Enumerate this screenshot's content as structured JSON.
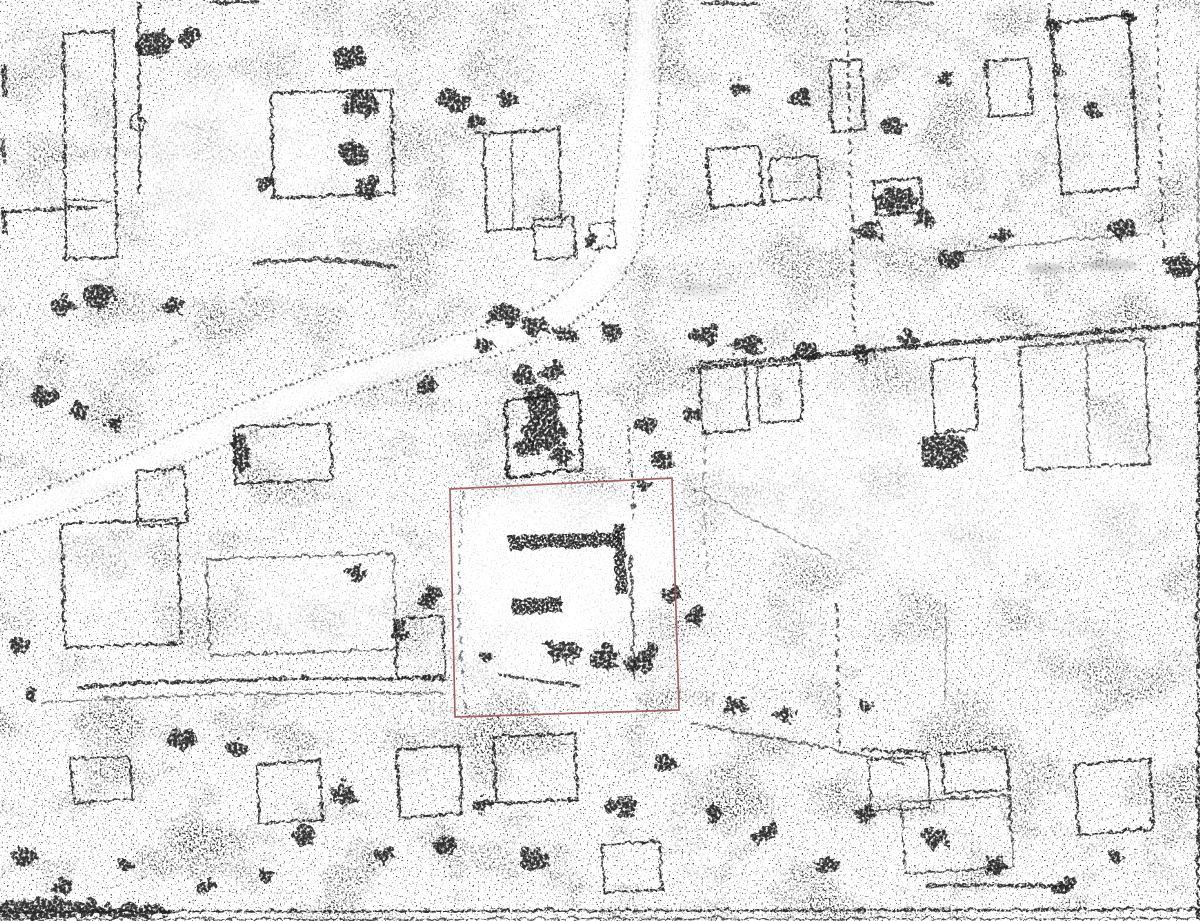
{
  "document": {
    "kind": "scanned-aerial-photograph",
    "visible_text": "none (no legible text in image)"
  },
  "canvas": {
    "width": 1200,
    "height": 921,
    "background": "#ffffff"
  },
  "palette": {
    "paper": "#ffffff",
    "ink": "#1d1d1d",
    "ink_soft": "#2e2e2e",
    "road_ink": "#303030",
    "smudge": "#777777",
    "red_boundary": "#a2585c"
  },
  "annotations": {
    "red_plot_boundary": {
      "points": "450,489 672,478 679,710 455,717",
      "stroke": "#a2585c",
      "stroke_width": 1.7,
      "opacity": 0.95
    },
    "center_building_outline": {
      "points": "504,399 577,391 581,468 507,476",
      "stroke": "#141414",
      "stroke_width": 3,
      "opacity": 0.95
    }
  },
  "features": {
    "road_style": {
      "width": 2.2,
      "dash": "2.5 3.5",
      "opacity": 0.85
    },
    "roads": [
      {
        "n": "road-edge-west",
        "d": "M628,-6 C622,70 621,150 609,228 C587,286 530,316 460,332 C370,353 294,378 209,416 C134,450 60,482 -6,506"
      },
      {
        "n": "road-edge-east",
        "d": "M666,-6 C659,85 653,165 639,243 C615,306 551,341 479,357 C391,378 311,403 229,441 C151,477 77,509 -6,533"
      }
    ],
    "clearing_strokes": [
      {
        "n": "road-surface",
        "d": "M647,-6 C640,80 636,160 622,236 C600,300 540,330 468,346 C380,366 300,392 216,430 C140,464 66,496 -6,520",
        "w": 26,
        "o": 0.9
      }
    ],
    "clearings": [
      [
        560,
        560,
        115,
        75,
        0.8
      ],
      [
        520,
        640,
        70,
        45,
        0.6
      ],
      [
        330,
        600,
        80,
        45,
        0.5
      ],
      [
        235,
        165,
        95,
        85,
        0.55
      ],
      [
        940,
        480,
        240,
        95,
        0.45
      ],
      [
        90,
        560,
        60,
        50,
        0.4
      ],
      [
        580,
        260,
        60,
        40,
        0.4
      ]
    ],
    "smudges": [
      [
        1045,
        268,
        20,
        5,
        0.3
      ],
      [
        1112,
        265,
        26,
        6,
        0.3
      ],
      [
        700,
        290,
        30,
        8,
        0.15
      ]
    ],
    "paths": [
      {
        "n": "pen-mark-line",
        "d": "M138,0 L138,192",
        "w": 2.6
      },
      {
        "n": "pen-mark-loop",
        "d": "M129,122 a7,8 0 1 0 14,0 a7,8 0 1 0 -14,0",
        "w": 2
      },
      {
        "n": "left-enclosure-outline",
        "d": "M62,32 L112,30 L116,255 L64,258 Z",
        "w": 2.5
      },
      {
        "n": "left-enclosure-inner",
        "d": "M64,198 L112,200",
        "w": 2
      },
      {
        "n": "house-outline",
        "d": "M270,92 L390,88 L393,192 L272,196 Z",
        "w": 3
      },
      {
        "n": "house-outline",
        "d": "M482,132 L557,128 L560,225 L485,229 Z",
        "w": 2.5
      },
      {
        "n": "house-inner-wall",
        "d": "M510,132 L512,228",
        "w": 2
      },
      {
        "n": "shed-outline",
        "d": "M532,218 L572,216 L574,256 L534,258 Z",
        "w": 2.5
      },
      {
        "n": "shed-outline",
        "d": "M588,222 L612,220 L614,246 L590,248 Z",
        "w": 2
      },
      {
        "n": "house-outline",
        "d": "M705,148 L758,144 L762,202 L709,206 Z",
        "w": 3
      },
      {
        "n": "house-outline",
        "d": "M768,158 L816,154 L819,196 L771,200 Z",
        "w": 2.5
      },
      {
        "n": "house-outline",
        "d": "M828,60 L860,58 L863,128 L831,130 Z",
        "w": 2.5
      },
      {
        "n": "house-outline",
        "d": "M872,180 L918,176 L921,210 L875,214 Z",
        "w": 3
      },
      {
        "n": "house-outline",
        "d": "M985,60 L1028,57 L1031,112 L988,115 Z",
        "w": 2.5
      },
      {
        "n": "large-building-outline",
        "d": "M1050,23 L1127,13 L1137,186 L1060,192 Z",
        "w": 3
      },
      {
        "n": "boundary-line",
        "d": "M1155,5 L1162,250",
        "w": 2.5,
        "dash": "7 6",
        "o": 0.8
      },
      {
        "n": "hedgerow-long-east",
        "d": "M688,368 C780,358 900,345 1000,338 C1080,332 1150,326 1200,322",
        "w": 4.5
      },
      {
        "n": "hedgerow",
        "d": "M845,5 C848,90 850,200 853,330",
        "w": 3,
        "dash": "6 5",
        "o": 0.85
      },
      {
        "n": "house-outline",
        "d": "M698,362 L744,358 L747,428 L701,432 Z",
        "w": 2.5
      },
      {
        "n": "house-outline",
        "d": "M755,365 L798,362 L801,418 L758,421 Z",
        "w": 2.5
      },
      {
        "n": "house-outline",
        "d": "M930,360 L973,356 L976,428 L933,432 Z",
        "w": 2.5
      },
      {
        "n": "field-enclosure-outline",
        "d": "M1018,345 L1143,338 L1148,462 L1023,468 Z",
        "w": 2.5,
        "o": 0.85
      },
      {
        "n": "field-enclosure-inner",
        "d": "M1085,340 L1088,465",
        "w": 2,
        "o": 0.7
      },
      {
        "n": "house-outline",
        "d": "M232,426 L328,422 L331,478 L235,482 Z",
        "w": 2.5
      },
      {
        "n": "house-outline",
        "d": "M135,470 L183,467 L186,522 L138,525 Z",
        "w": 2.5
      },
      {
        "n": "farm-enclosure-outline",
        "d": "M60,522 L176,518 L180,642 L64,646 Z",
        "w": 2.5
      },
      {
        "n": "field-boundary",
        "d": "M205,558 L392,552 L396,648 L209,654 Z",
        "w": 2,
        "o": 0.75
      },
      {
        "n": "plot-building-wall",
        "d": "M507,534 L619,530 L620,545 L508,549 Z",
        "w": 1,
        "f": 1
      },
      {
        "n": "plot-building-wall",
        "d": "M612,523 L623,522 L626,592 L615,593 Z",
        "w": 1,
        "f": 1
      },
      {
        "n": "plot-building-wall",
        "d": "M509,598 L560,595 L562,611 L511,613 Z",
        "w": 1,
        "f": 1
      },
      {
        "n": "plot-fence-line",
        "d": "M629,553 L633,680",
        "w": 2.5,
        "o": 0.8
      },
      {
        "n": "plot-track-line",
        "d": "M497,672 C520,676 550,681 578,684",
        "w": 3,
        "o": 0.85
      },
      {
        "n": "plot-west-fence",
        "d": "M462,490 C458,540 456,600 460,660 C461,680 463,700 466,716",
        "w": 2,
        "o": 0.6,
        "dash": "9 7"
      },
      {
        "n": "track-hedgerow",
        "d": "M75,686 C190,678 320,675 448,678",
        "w": 3.5
      },
      {
        "n": "track-edge",
        "d": "M40,701 C150,694 300,690 446,692",
        "w": 2,
        "o": 0.65
      },
      {
        "n": "house-outline",
        "d": "M70,758 L128,755 L131,798 L73,801 Z",
        "w": 2.5
      },
      {
        "n": "house-outline",
        "d": "M255,763 L318,759 L321,818 L258,822 Z",
        "w": 2.5
      },
      {
        "n": "house-outline",
        "d": "M395,748 L458,744 L461,812 L398,816 Z",
        "w": 3
      },
      {
        "n": "house-outline",
        "d": "M492,736 L573,732 L576,798 L495,802 Z",
        "w": 3
      },
      {
        "n": "house-outline",
        "d": "M600,843 L658,840 L661,888 L603,891 Z",
        "w": 2.5
      },
      {
        "n": "house-outline",
        "d": "M1073,763 L1148,758 L1152,828 L1077,833 Z",
        "w": 2.5
      },
      {
        "n": "house-outline",
        "d": "M900,800 L1008,794 L1012,866 L904,872 Z",
        "w": 2,
        "o": 0.8
      },
      {
        "n": "house-outline",
        "d": "M940,752 L1005,748 L1008,788 L943,792 Z",
        "w": 2.5
      },
      {
        "n": "house-outline",
        "d": "M867,758 L925,755 L928,806 L870,809 Z",
        "w": 2
      },
      {
        "n": "house-outline",
        "d": "M393,618 L441,615 L444,674 L396,677 Z",
        "w": 2.5
      },
      {
        "n": "hedgerow",
        "d": "M925,884 C975,882 1030,884 1072,886",
        "w": 3.5,
        "o": 0.9
      },
      {
        "n": "fence-line",
        "d": "M945,600 L943,700",
        "w": 2,
        "o": 0.5
      },
      {
        "n": "fence-line",
        "d": "M835,602 L838,745",
        "w": 2.5,
        "o": 0.8,
        "dash": "9 6"
      },
      {
        "n": "fence-line",
        "d": "M858,748 L927,752",
        "w": 3
      },
      {
        "n": "hedgerow",
        "d": "M690,722 C780,738 850,752 905,762",
        "w": 2.5,
        "o": 0.75
      },
      {
        "n": "hedgerow",
        "d": "M250,262 C300,256 350,258 395,266",
        "w": 4,
        "o": 0.85
      },
      {
        "n": "hedgerow",
        "d": "M0,210 L95,206",
        "w": 3
      },
      {
        "n": "field-line",
        "d": "M690,487 L830,557",
        "w": 1.5,
        "o": 0.55
      },
      {
        "n": "fence-line",
        "d": "M627,425 L633,518",
        "w": 2.5,
        "dash": "6 5",
        "o": 0.8
      },
      {
        "n": "fence-line",
        "d": "M704,432 C702,480 703,530 706,575",
        "w": 2,
        "o": 0.5,
        "dash": "7 6"
      },
      {
        "n": "path-line",
        "d": "M140,360 C180,340 222,312 258,282",
        "w": 2,
        "o": 0.5,
        "dash": "4 5"
      },
      {
        "n": "hedgerow",
        "d": "M950,252 C1010,244 1080,238 1150,232",
        "w": 2.2,
        "o": 0.6
      },
      {
        "n": "frame-border-bottom",
        "d": "M0,910 L1200,908",
        "w": 2.4
      },
      {
        "n": "frame-border-bottom-inner",
        "d": "M0,918 L1200,917",
        "w": 1.4,
        "o": 0.85
      },
      {
        "n": "frame-border-right",
        "d": "M1196,64 L1197,250",
        "w": 2,
        "o": 0.55
      },
      {
        "n": "frame-border-right",
        "d": "M1197,250 L1197,918",
        "w": 2.6,
        "o": 0.95
      },
      {
        "n": "edge-mark",
        "d": "M2,64 L4,96",
        "w": 5,
        "o": 0.9
      },
      {
        "n": "edge-mark",
        "d": "M1,138 L3,162",
        "w": 4,
        "o": 0.85
      },
      {
        "n": "edge-mark",
        "d": "M2,206 L4,234",
        "w": 5,
        "o": 0.9
      },
      {
        "n": "edge-mark",
        "d": "M208,2 L258,0",
        "w": 4,
        "o": 0.9
      },
      {
        "n": "edge-mark",
        "d": "M700,1 L758,3",
        "w": 3.5,
        "o": 0.85
      },
      {
        "n": "edge-mark",
        "d": "M878,0 L932,2",
        "w": 3,
        "o": 0.8
      },
      {
        "n": "edge-mark",
        "d": "M1048,3 L1046,30",
        "w": 3,
        "o": 0.8
      }
    ],
    "blobs": [
      [
        150,
        40,
        20,
        14
      ],
      [
        187,
        34,
        13,
        10
      ],
      [
        345,
        55,
        16,
        12
      ],
      [
        358,
        100,
        18,
        13
      ],
      [
        350,
        150,
        15,
        11
      ],
      [
        364,
        185,
        12,
        9
      ],
      [
        450,
        97,
        17,
        11
      ],
      [
        505,
        95,
        11,
        8
      ],
      [
        262,
        180,
        11,
        8
      ],
      [
        472,
        120,
        10,
        8
      ],
      [
        500,
        312,
        17,
        11
      ],
      [
        532,
        322,
        15,
        10
      ],
      [
        562,
        332,
        12,
        9
      ],
      [
        480,
        342,
        11,
        8
      ],
      [
        424,
        382,
        11,
        8
      ],
      [
        608,
        330,
        9,
        7
      ],
      [
        588,
        238,
        9,
        7
      ],
      [
        95,
        292,
        17,
        12
      ],
      [
        60,
        302,
        13,
        9
      ],
      [
        40,
        396,
        14,
        10
      ],
      [
        76,
        407,
        11,
        8
      ],
      [
        112,
        420,
        9,
        7
      ],
      [
        170,
        302,
        11,
        8
      ],
      [
        520,
        372,
        14,
        10
      ],
      [
        549,
        368,
        12,
        9
      ],
      [
        538,
        392,
        20,
        8
      ],
      [
        542,
        430,
        22,
        16
      ],
      [
        524,
        446,
        14,
        10
      ],
      [
        560,
        452,
        12,
        9
      ],
      [
        540,
        408,
        16,
        12
      ],
      [
        700,
        332,
        14,
        10
      ],
      [
        745,
        342,
        16,
        11
      ],
      [
        802,
        347,
        12,
        9
      ],
      [
        860,
        352,
        10,
        8
      ],
      [
        906,
        337,
        10,
        7
      ],
      [
        948,
        256,
        12,
        9
      ],
      [
        1000,
        232,
        10,
        8
      ],
      [
        1120,
        226,
        14,
        10
      ],
      [
        1178,
        262,
        16,
        12
      ],
      [
        1090,
        107,
        10,
        8
      ],
      [
        890,
        122,
        12,
        9
      ],
      [
        940,
        77,
        9,
        7
      ],
      [
        865,
        232,
        13,
        10
      ],
      [
        920,
        216,
        10,
        8
      ],
      [
        795,
        95,
        11,
        8
      ],
      [
        735,
        85,
        10,
        8
      ],
      [
        645,
        422,
        10,
        8
      ],
      [
        660,
        457,
        11,
        9
      ],
      [
        640,
        482,
        8,
        6
      ],
      [
        688,
        412,
        9,
        7
      ],
      [
        667,
        592,
        9,
        7
      ],
      [
        692,
        612,
        11,
        8
      ],
      [
        560,
        648,
        18,
        11
      ],
      [
        600,
        655,
        16,
        10
      ],
      [
        635,
        660,
        14,
        10
      ],
      [
        648,
        648,
        10,
        8
      ],
      [
        483,
        652,
        8,
        6
      ],
      [
        940,
        447,
        24,
        17
      ],
      [
        893,
        196,
        20,
        13
      ],
      [
        237,
        452,
        8,
        24
      ],
      [
        1050,
        23,
        6,
        6
      ],
      [
        1127,
        14,
        7,
        6
      ],
      [
        1056,
        68,
        5,
        5
      ],
      [
        180,
        736,
        14,
        10
      ],
      [
        232,
        746,
        12,
        9
      ],
      [
        340,
        792,
        14,
        10
      ],
      [
        300,
        832,
        12,
        9
      ],
      [
        382,
        852,
        10,
        8
      ],
      [
        440,
        842,
        12,
        9
      ],
      [
        530,
        856,
        14,
        10
      ],
      [
        480,
        802,
        10,
        8
      ],
      [
        620,
        802,
        14,
        10
      ],
      [
        662,
        762,
        12,
        9
      ],
      [
        712,
        812,
        10,
        8
      ],
      [
        762,
        832,
        13,
        10
      ],
      [
        822,
        862,
        12,
        9
      ],
      [
        862,
        812,
        10,
        8
      ],
      [
        932,
        836,
        13,
        10
      ],
      [
        992,
        862,
        11,
        8
      ],
      [
        1062,
        882,
        10,
        8
      ],
      [
        1112,
        852,
        8,
        6
      ],
      [
        732,
        702,
        12,
        8
      ],
      [
        782,
        712,
        10,
        7
      ],
      [
        862,
        702,
        8,
        6
      ],
      [
        15,
        642,
        10,
        8
      ],
      [
        30,
        692,
        8,
        6
      ],
      [
        20,
        852,
        12,
        9
      ],
      [
        62,
        882,
        10,
        8
      ],
      [
        122,
        862,
        8,
        6
      ],
      [
        202,
        882,
        10,
        7
      ],
      [
        262,
        872,
        8,
        6
      ],
      [
        352,
        570,
        10,
        7
      ],
      [
        420,
        600,
        9,
        7
      ],
      [
        398,
        628,
        10,
        7
      ],
      [
        430,
        592,
        8,
        6
      ],
      [
        40,
        905,
        60,
        10
      ],
      [
        130,
        908,
        40,
        7
      ]
    ]
  }
}
